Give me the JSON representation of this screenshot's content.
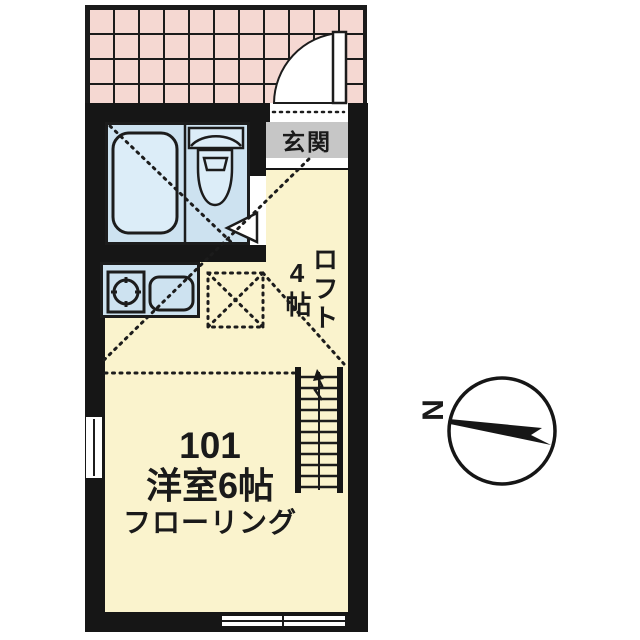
{
  "document_type": "japanese-apartment-floor-plan",
  "labels": {
    "entrance": "玄関",
    "loft": "ロフト",
    "loft_size": "4帖",
    "unit_number": "101",
    "room_type": "洋室6帖",
    "flooring": "フローリング",
    "north": "N"
  },
  "rooms": [
    {
      "name": "entrance",
      "label": "玄関"
    },
    {
      "name": "unit-bath",
      "fixtures": [
        "bathtub",
        "toilet"
      ]
    },
    {
      "name": "kitchen",
      "fixtures": [
        "burner",
        "sink"
      ]
    },
    {
      "name": "main-room",
      "label": "101 洋室6帖 フローリング"
    },
    {
      "name": "loft",
      "label": "ロフト 4帖"
    }
  ],
  "icons": [
    "entrance-door-icon",
    "bathtub-icon",
    "toilet-icon",
    "burner-icon",
    "kitchen-sink-icon",
    "loft-hatch-icon",
    "loft-ladder-icon",
    "window-icon",
    "compass-icon"
  ],
  "colors": {
    "wall": "#161616",
    "tile_pink": "#f5d8d2",
    "room_cream": "#faf3cd",
    "fixture_blue": "#cde2f0",
    "fixture_light": "#dcedf8",
    "entrance_gray": "#c6c6c6",
    "line": "#1c1c1c"
  }
}
